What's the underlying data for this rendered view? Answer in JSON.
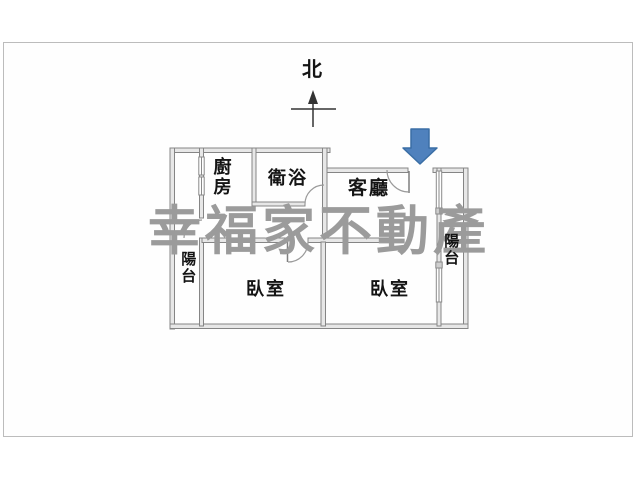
{
  "compass": {
    "label": "北"
  },
  "watermark": {
    "text": "幸福家不動產",
    "color": "#9b9b9b"
  },
  "rooms": {
    "kitchen": "廚房",
    "bathroom": "衛浴",
    "living_room": "客廳",
    "bedroom_left": "臥室",
    "bedroom_right": "臥室",
    "balcony_left": "陽台",
    "balcony_right": "陽台"
  },
  "entrance_arrow": {
    "direction": "down",
    "fill": "#4f81bd",
    "stroke": "#3a6ea5"
  },
  "plan_style": {
    "wall_fill": "#e7e7e7",
    "wall_stroke": "#858585"
  }
}
